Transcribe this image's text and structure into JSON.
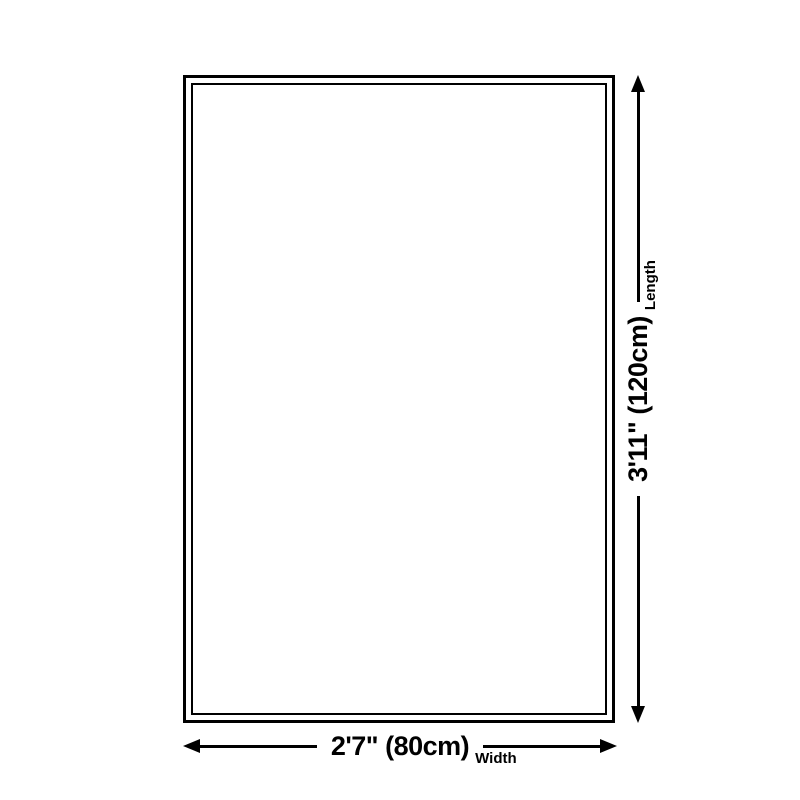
{
  "diagram": {
    "background_color": "#ffffff",
    "line_color": "#000000",
    "vertical_dimension": {
      "value": "3'11\" (120cm)",
      "label": "Length"
    },
    "horizontal_dimension": {
      "value": "2'7\" (80cm)",
      "label": "Width"
    }
  }
}
